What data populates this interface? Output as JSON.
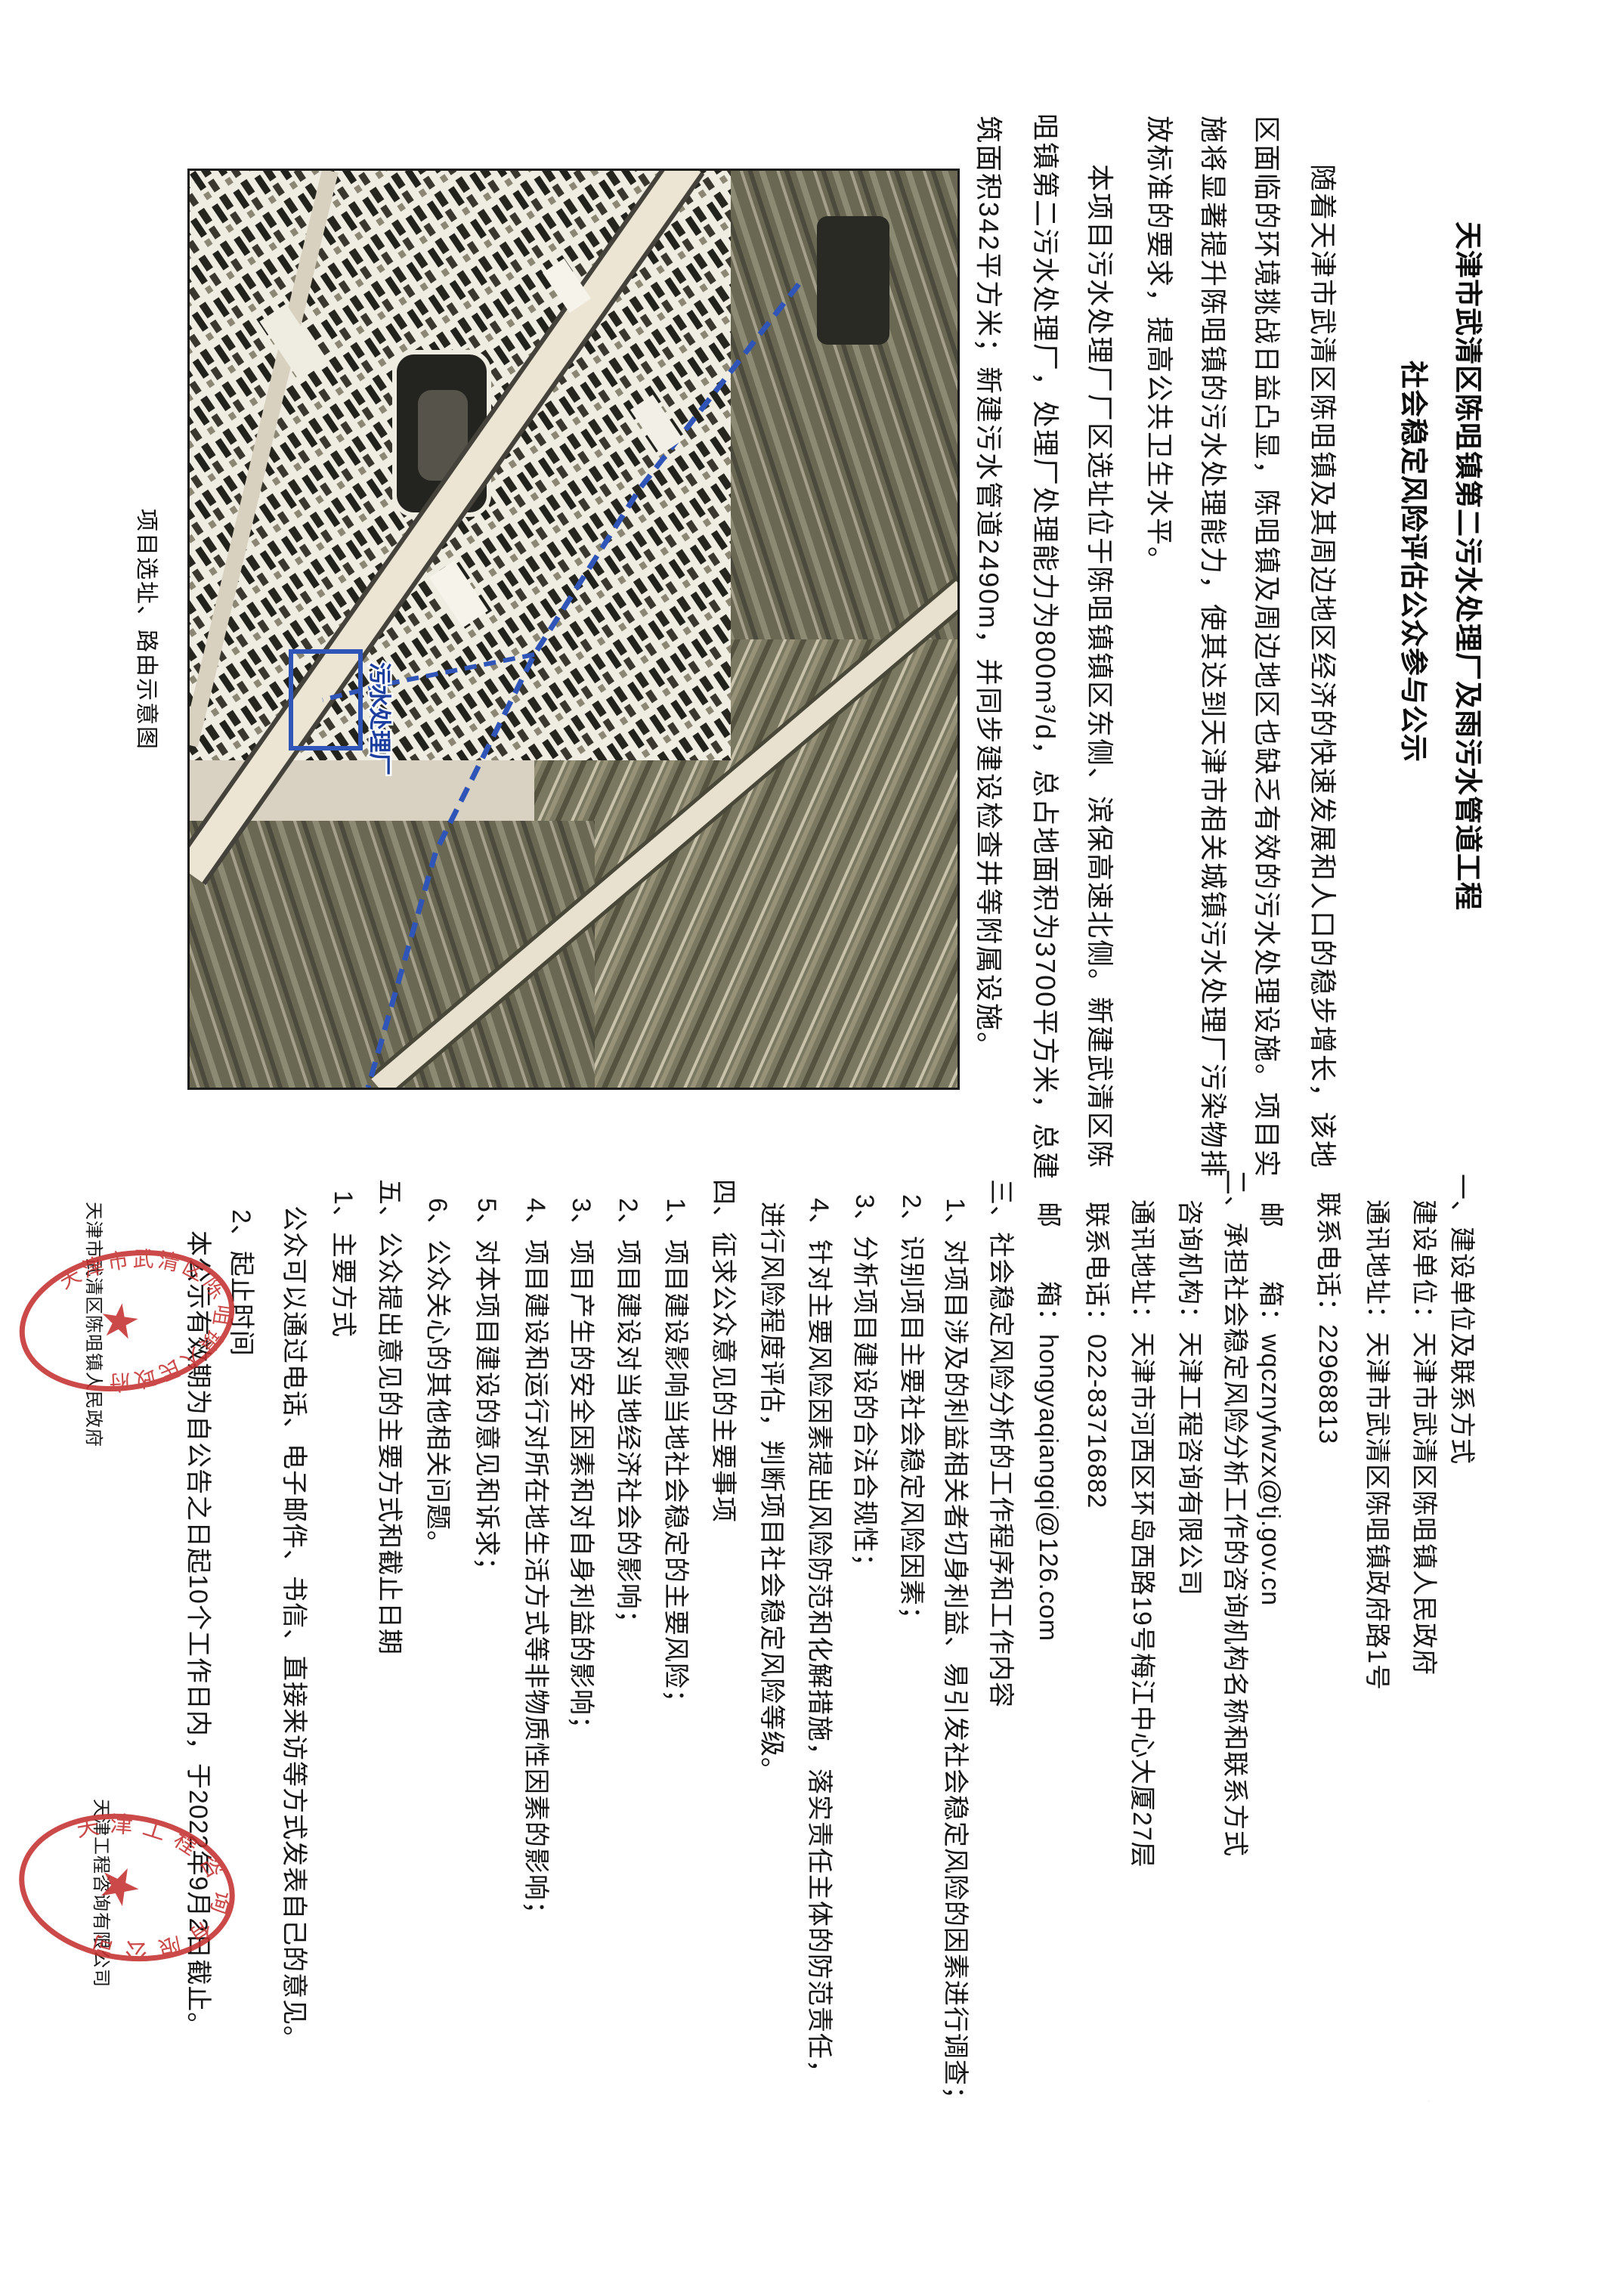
{
  "notice": {
    "title_lines": [
      "天津市武清区陈咀镇第二污水处理厂及雨污水管道工程",
      "社会稳定风险评估公众参与公示"
    ],
    "paragraph1_lines": [
      "随着天津市武清区陈咀镇及其周边地区经济的快速发展和人口的稳步增长，该地",
      "区面临的环境挑战日益凸显，陈咀镇及周边地区也缺乏有效的污水处理设施。项目实",
      "施将显著提升陈咀镇的污水处理能力，使其达到天津市相关城镇污水处理厂污染物排",
      "放标准的要求，提高公共卫生水平。"
    ],
    "paragraph2_lines": [
      "本项目污水处理厂厂区选址位于陈咀镇镇区东侧、滨保高速北侧。新建武清区陈",
      "咀镇第二污水处理厂，处理厂处理能力为800m³/d，总占地面积为3700平方米，总建",
      "筑面积342平方米；新建污水管道2490m，并同步建设检查井等附属设施。"
    ],
    "section_lines": [
      "一、建设单位及联系方式",
      "建设单位：天津市武清区陈咀镇人民政府",
      "通讯地址：天津市武清区陈咀镇政府路1号",
      "联系电话：22968813",
      "邮　　箱：wqcznyfwzx@tj.gov.cn",
      "二、承担社会稳定风险分析工作的咨询机构名称和联系方式",
      "咨询机构：天津工程咨询有限公司",
      "通讯地址：天津市河西区环岛西路19号梅江中心大厦27层",
      "联系电话：022-83716882",
      "邮　　箱：hongyaqiangqi@126.com",
      "三、社会稳定风险分析的工作程序和工作内容",
      "1、对项目涉及的利益相关者切身利益、易引发社会稳定风险的因素进行调查；",
      "2、识别项目主要社会稳定风险因素；",
      "3、分析项目建设的合法合规性；",
      "4、针对主要风险因素提出风险防范和化解措施，落实责任主体的防范责任，",
      "进行风险程度评估，判断项目社会稳定风险等级。",
      "四、征求公众意见的主要事项",
      "1、项目建设影响当地社会稳定的主要风险；",
      "2、项目建设对当地经济社会的影响；",
      "3、项目产生的安全因素和对自身利益的影响；",
      "4、项目建设和运行对所在地生活方式等非物质性因素的影响；",
      "5、对本项目建设的意见和诉求；",
      "6、公众关心的其他相关问题。",
      "五、公众提出意见的主要方式和截止日期",
      "1、主要方式",
      "公众可以通过电话、电子邮件、书信、直接来访等方式发表自己的意见。",
      "2、起止时间",
      "本公示有效期为自公告之日起10个工作日内，于2022年9月2日截止。"
    ],
    "signatures": [
      "天津市武清区陈咀镇人民政府",
      "天津工程咨询有限公司"
    ],
    "seals": [
      {
        "text": "天津市武清区陈咀镇人民政府"
      },
      {
        "text": "天津工程咨询有限公司"
      }
    ],
    "map": {
      "caption": "项目选址、路由示意图",
      "plant_label": "污水处理厂"
    },
    "accent_colors": {
      "seal_red": "#c43030",
      "route_blue": "#2f55b8",
      "ink": "#151515"
    }
  }
}
